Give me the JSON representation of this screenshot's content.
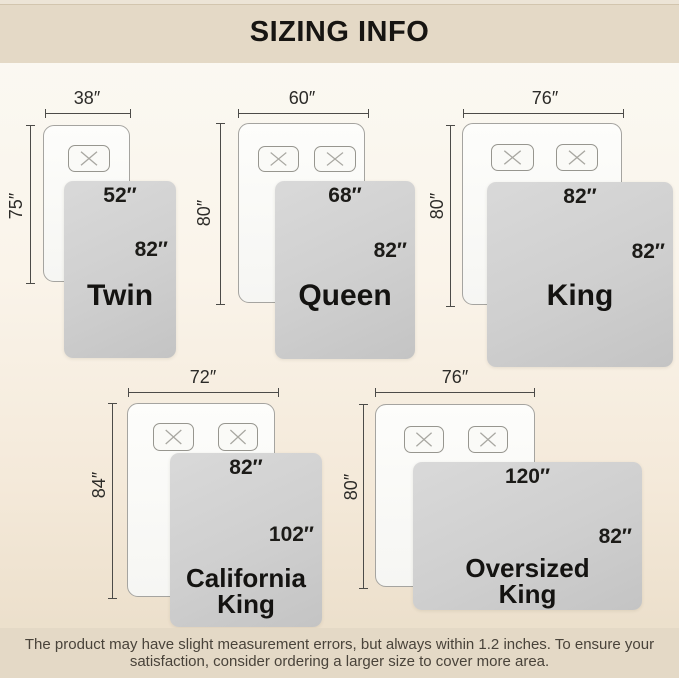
{
  "title": "SIZING INFO",
  "footer": {
    "line1": "The product may have slight measurement errors, but always within 1.2 inches. To ensure your",
    "line2": "satisfaction, consider ordering a larger size to cover more area."
  },
  "sizes": [
    {
      "name": "Twin",
      "bed_width": "38″",
      "bed_length": "75″",
      "blanket_width": "52″",
      "blanket_length": "82″",
      "pillows": 1
    },
    {
      "name": "Queen",
      "bed_width": "60″",
      "bed_length": "80″",
      "blanket_width": "68″",
      "blanket_length": "82″",
      "pillows": 2
    },
    {
      "name": "King",
      "bed_width": "76″",
      "bed_length": "80″",
      "blanket_width": "82″",
      "blanket_length": "82″",
      "pillows": 2
    },
    {
      "name": "California King",
      "bed_width": "72″",
      "bed_length": "84″",
      "blanket_width": "82″",
      "blanket_length": "102″",
      "pillows": 2
    },
    {
      "name": "Oversized King",
      "bed_width": "76″",
      "bed_length": "80″",
      "blanket_width": "120″",
      "blanket_length": "82″",
      "pillows": 2
    }
  ],
  "colors": {
    "band": "#e4d9c6",
    "blanket_gray": "#cfcfcf",
    "bed_white": "#fbfbf9",
    "text_dark": "#1c1b18"
  }
}
